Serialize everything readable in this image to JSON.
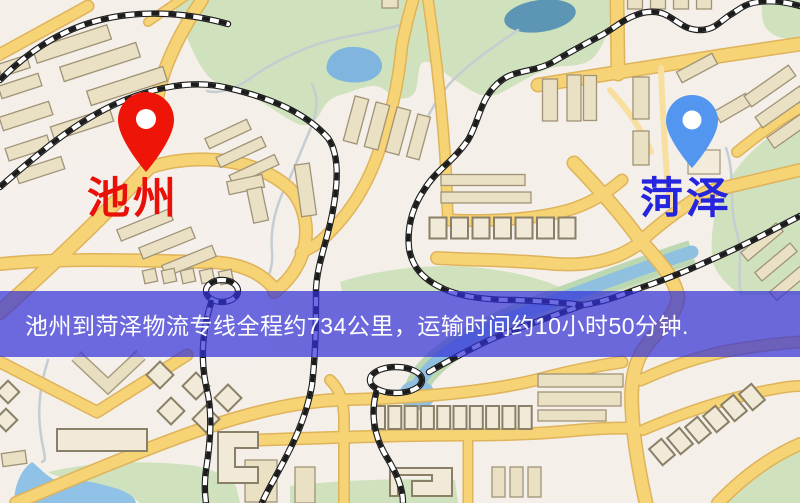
{
  "banner": {
    "text": "池州到菏泽物流专线全程约734公里，运输时间约10小时50分钟.",
    "background_color": "rgba(49,47,215,0.70)",
    "text_color": "#ffffff"
  },
  "markers": {
    "origin": {
      "label": "池州",
      "pin_color": "#ee1408",
      "label_color": "#e81008"
    },
    "destination": {
      "label": "菏泽",
      "pin_color": "#5296f0",
      "label_color": "#2525dd"
    }
  },
  "route": {
    "origin_city": "池州",
    "destination_city": "菏泽",
    "distance_text": "约734公里",
    "duration_text": "约10小时50分钟"
  },
  "map_colors": {
    "background": "#f4efe8",
    "road_fill": "#f6d476",
    "road_casing": "#dfb35a",
    "park": "#cfe2bd",
    "lake": "#7fb5de",
    "river": "#8fc0e0",
    "building": "#eae0c4",
    "railway": "#1c1c1c",
    "stream": "#c4cdd1"
  }
}
